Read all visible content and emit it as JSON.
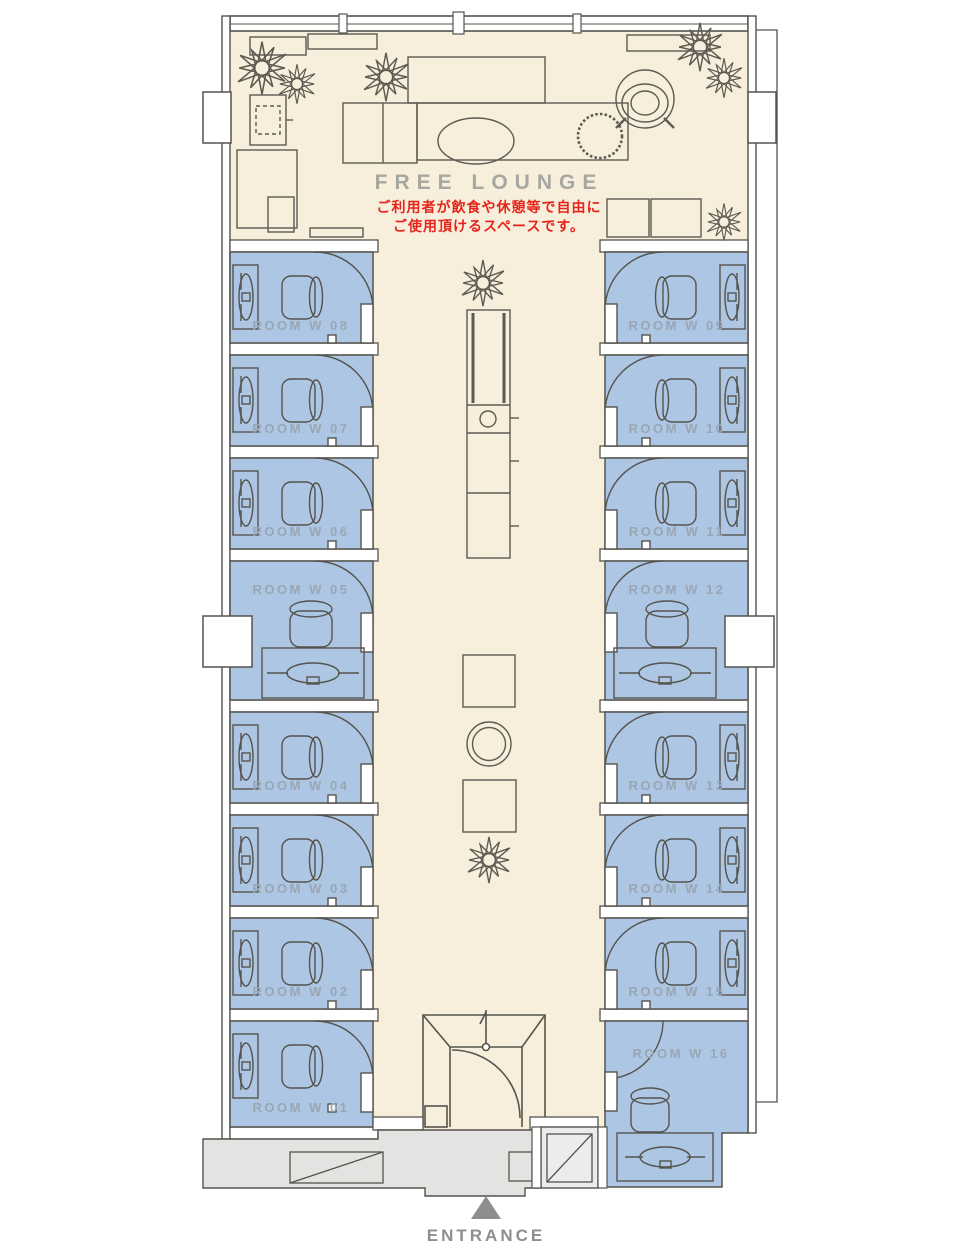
{
  "floorplan": {
    "lounge": {
      "title": "FREE LOUNGE",
      "note_line1": "ご利用者が飲食や休憩等で自由に",
      "note_line2": "ご使用頂けるスペースです。"
    },
    "entrance": {
      "label": "ENTRANCE"
    },
    "rooms": {
      "left": [
        "ROOM W 08",
        "ROOM W 07",
        "ROOM W 06",
        "ROOM W 05",
        "ROOM W 04",
        "ROOM W 03",
        "ROOM W 02",
        "ROOM W 01"
      ],
      "right": [
        "ROOM W 09",
        "ROOM W 10",
        "ROOM W 11",
        "ROOM W 12",
        "ROOM W 13",
        "ROOM W 14",
        "ROOM W 15",
        "ROOM W 16"
      ]
    },
    "icons": {
      "plant": "star-leaf-plant",
      "entrance_arrow": "triangle-up"
    },
    "colors": {
      "room_fill": "#adc6e3",
      "lounge_fill": "#f7efdc",
      "walkway_fill": "#e3e3e2",
      "wall_line": "#55534d",
      "room_label": "#9aa6b4",
      "lounge_title": "#a7a7a1",
      "note_red": "#e8231a",
      "entrance_gray": "#8e8e8e"
    }
  }
}
